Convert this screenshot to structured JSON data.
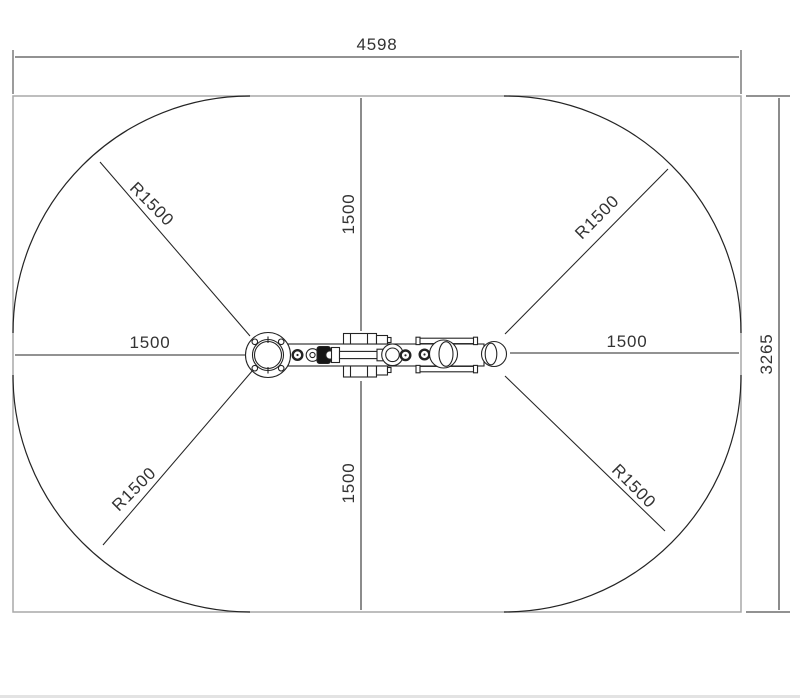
{
  "drawing": {
    "dimensions": {
      "overall_width": "4598",
      "overall_height": "3265",
      "clearance_left": "1500",
      "clearance_right": "1500",
      "clearance_top": "1500",
      "clearance_bottom": "1500",
      "radius_top_left": "R1500",
      "radius_top_right": "R1500",
      "radius_bottom_left": "R1500",
      "radius_bottom_right": "R1500"
    }
  },
  "colors": {
    "background": "#ffffff",
    "boundary_gray": "#a9a9a9",
    "line_dark": "#242424",
    "dim_text": "#333333"
  }
}
